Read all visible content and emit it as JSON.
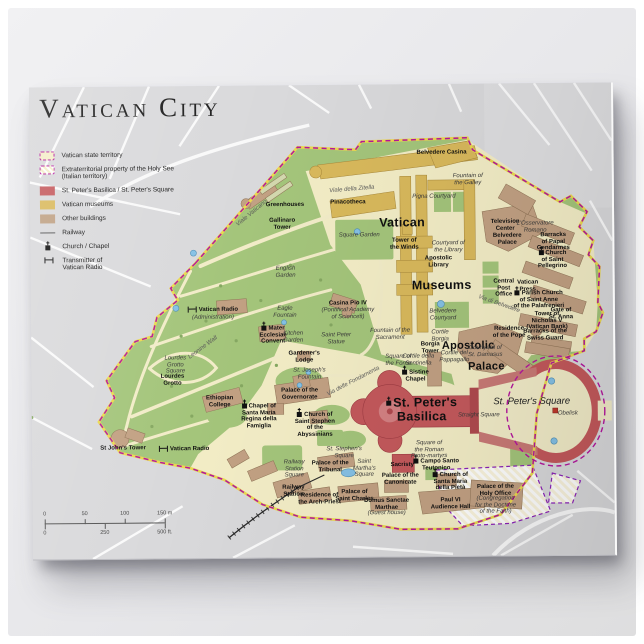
{
  "title": "Vatican City",
  "legend": {
    "items": [
      {
        "type": "territory",
        "label": "Vatican state territory"
      },
      {
        "type": "extraterritorial",
        "label": "Extraterritorial property of the Holy See\n(Italian territory)"
      },
      {
        "type": "basilica",
        "label": "St. Peter's Basilica / St. Peter's Square"
      },
      {
        "type": "museums",
        "label": "Vatican museums"
      },
      {
        "type": "buildings",
        "label": "Other buildings"
      },
      {
        "type": "railway",
        "label": "Railway"
      },
      {
        "type": "church",
        "label": "Church / Chapel"
      },
      {
        "type": "transmitter",
        "label": "Transmitter of\nVatican Radio"
      }
    ]
  },
  "scalebar": {
    "meters": [
      "0",
      "50",
      "100",
      "150 m"
    ],
    "feet": [
      "0",
      "250",
      "500 ft."
    ]
  },
  "colors": {
    "map_background": "#d9d9db",
    "territory_green": "#a4c57b",
    "built_area": "#f3edc6",
    "basilica_red": "#c4595c",
    "museums_yellow": "#d9b95c",
    "buildings_tan": "#c2a183",
    "border_magenta": "#b5179e",
    "extraterritorial_purple": "#8b22b8",
    "water_blue": "#85c1e5"
  },
  "map": {
    "labels": [
      {
        "t": "Vatican",
        "x": 372,
        "y": 139,
        "c": "big"
      },
      {
        "t": "Museums",
        "x": 411,
        "y": 202,
        "c": "big"
      },
      {
        "t": "Apostolic",
        "x": 437,
        "y": 262,
        "c": "big2"
      },
      {
        "t": "Palace",
        "x": 455,
        "y": 283,
        "c": "big2"
      },
      {
        "t": "St. Peter's\nBasilica",
        "x": 390,
        "y": 326,
        "c": "big",
        "icon": "church"
      },
      {
        "t": "St. Peter's Square",
        "x": 500,
        "y": 319,
        "c": "bigit"
      },
      {
        "t": "Belvedere Casina",
        "x": 412,
        "y": 69
      },
      {
        "t": "Fountain of\nthe Galley",
        "x": 438,
        "y": 96,
        "c": "it"
      },
      {
        "t": "Pigna Courtyard",
        "x": 404,
        "y": 113,
        "c": "it"
      },
      {
        "t": "Greenhouses",
        "x": 255,
        "y": 120
      },
      {
        "t": "Gallinaro\nTower",
        "x": 252,
        "y": 139
      },
      {
        "t": "Viale della Zitella",
        "x": 322,
        "y": 105,
        "c": "road",
        "r": -4
      },
      {
        "t": "Pinacotheca",
        "x": 318,
        "y": 118
      },
      {
        "t": "Square Garden",
        "x": 329,
        "y": 151,
        "c": "it"
      },
      {
        "t": "English\nGarden",
        "x": 255,
        "y": 187,
        "c": "it"
      },
      {
        "t": "Viale Vaticano",
        "x": 222,
        "y": 128,
        "c": "road",
        "r": -39
      },
      {
        "t": "Tower of\nthe Winds",
        "x": 374,
        "y": 160
      },
      {
        "t": "Courtyard of\nthe Library",
        "x": 418,
        "y": 163,
        "c": "it"
      },
      {
        "t": "Apostolic\nLibrary",
        "x": 408,
        "y": 178
      },
      {
        "t": "Television\nCenter",
        "x": 475,
        "y": 142
      },
      {
        "t": "L'Osservatore\nRomano",
        "x": 505,
        "y": 144,
        "c": "it"
      },
      {
        "t": "Belvedere\nPalace",
        "x": 477,
        "y": 156
      },
      {
        "t": "Barracks\nof Papal\nGendarmes",
        "x": 523,
        "y": 159
      },
      {
        "t": "Church\nof Saint\nPellegrino",
        "x": 522,
        "y": 177,
        "icon": "church"
      },
      {
        "t": "Central\nPost\nOffice",
        "x": 473,
        "y": 205
      },
      {
        "t": "Vatican\nPress",
        "x": 497,
        "y": 203
      },
      {
        "t": "Parish Church\nof Saint Anne\nof the Palafrenieri",
        "x": 508,
        "y": 217,
        "icon": "church"
      },
      {
        "t": "Gate of\nSt. Anna",
        "x": 530,
        "y": 231
      },
      {
        "t": "Tower of\nNicholas V\n(Vatican Bank)",
        "x": 516,
        "y": 238
      },
      {
        "t": "Barracks of the\nSwiss Guard",
        "x": 514,
        "y": 252
      },
      {
        "t": "Residence\nof the Pope",
        "x": 478,
        "y": 249
      },
      {
        "t": "Via di Belvedere",
        "x": 468,
        "y": 221,
        "c": "road",
        "r": 20
      },
      {
        "t": "Belvedere\nCourtyard",
        "x": 412,
        "y": 231,
        "c": "it"
      },
      {
        "t": "Cortile\nBorgia",
        "x": 409,
        "y": 252,
        "c": "it"
      },
      {
        "t": "Borgia\nTower",
        "x": 399,
        "y": 264
      },
      {
        "t": "Cortile della\nSentinella",
        "x": 387,
        "y": 276,
        "c": "it"
      },
      {
        "t": "Cortile del\nPappagallo",
        "x": 423,
        "y": 273,
        "c": "it"
      },
      {
        "t": "Courtyard of\nSt. Damasus",
        "x": 454,
        "y": 268,
        "c": "it"
      },
      {
        "t": "Sistine\nChapel",
        "x": 384,
        "y": 292,
        "icon": "church"
      },
      {
        "t": "Square of\nthe Forno",
        "x": 367,
        "y": 276,
        "c": "it"
      },
      {
        "t": "Straight Square",
        "x": 447,
        "y": 332,
        "c": "it"
      },
      {
        "t": "Obelisk",
        "x": 536,
        "y": 331,
        "c": "it"
      },
      {
        "t": "Square of\nthe Roman\nProto-martyrs",
        "x": 397,
        "y": 366,
        "c": "it"
      },
      {
        "t": "Sacristy",
        "x": 370,
        "y": 381
      },
      {
        "t": "Campo Santo\nTeutonico",
        "x": 404,
        "y": 381,
        "icon": "church"
      },
      {
        "t": "Church of\nSanta Maria\ndella Pietà",
        "x": 418,
        "y": 398,
        "icon": "church"
      },
      {
        "t": "Paul VI\nAudience Hall",
        "x": 418,
        "y": 420
      },
      {
        "t": "Palace of the\nHoly Office",
        "x": 463,
        "y": 407
      },
      {
        "t": "(Congregation\nfor the Doctrine\nof the Faith)",
        "x": 463,
        "y": 422,
        "c": "it"
      },
      {
        "t": "Palace of the\nCanonicate",
        "x": 368,
        "y": 395
      },
      {
        "t": "Domus Sanctae\nMarthae",
        "x": 354,
        "y": 420
      },
      {
        "t": "(Guest house)",
        "x": 354,
        "y": 429,
        "c": "it"
      },
      {
        "t": "Palace of\nSaint Charles",
        "x": 322,
        "y": 411
      },
      {
        "t": "Residence of\nthe Arch-Priest",
        "x": 287,
        "y": 414
      },
      {
        "t": "Railway\nStation",
        "x": 261,
        "y": 406
      },
      {
        "t": "Railway\nStation\nSquare",
        "x": 262,
        "y": 384,
        "c": "it"
      },
      {
        "t": "Palace of the\nTribunal",
        "x": 298,
        "y": 382
      },
      {
        "t": "Saint\nMartha's\nSquare",
        "x": 332,
        "y": 384,
        "c": "it"
      },
      {
        "t": "St. Stephen's\nSquare",
        "x": 312,
        "y": 368,
        "c": "it"
      },
      {
        "t": "Church of\nSaint Stephen\nof the\nAbyssinians",
        "x": 283,
        "y": 340,
        "icon": "church"
      },
      {
        "t": "Chapel of\nSanta Maria\nRegina della\nFamiglia",
        "x": 227,
        "y": 331,
        "icon": "church"
      },
      {
        "t": "Ethiopian\nCollege",
        "x": 188,
        "y": 316
      },
      {
        "t": "Palace of the\nGovernorate",
        "x": 268,
        "y": 309
      },
      {
        "t": "St. Joseph's\nFountain",
        "x": 278,
        "y": 289,
        "c": "it"
      },
      {
        "t": "Gardener's\nLodge",
        "x": 273,
        "y": 272
      },
      {
        "t": "Saint Peter\nStatue",
        "x": 305,
        "y": 254,
        "c": "it"
      },
      {
        "t": "Fountain of the\nSacrament",
        "x": 359,
        "y": 250,
        "c": "it"
      },
      {
        "t": "Casina Pio IV",
        "x": 317,
        "y": 219
      },
      {
        "t": "(Pontifical Academy\nof Sciences)",
        "x": 317,
        "y": 229,
        "c": "it"
      },
      {
        "t": "Mater\nEcclesiae\nConvent",
        "x": 242,
        "y": 250,
        "icon": "church"
      },
      {
        "t": "Kitchen\nGarden",
        "x": 262,
        "y": 252,
        "c": "it"
      },
      {
        "t": "Eagle\nFountain",
        "x": 254,
        "y": 227,
        "c": "it"
      },
      {
        "t": "Vatican Radio",
        "x": 182,
        "y": 224,
        "icon": "transmitter"
      },
      {
        "t": "(Administration)",
        "x": 182,
        "y": 232,
        "c": "it"
      },
      {
        "t": "Lourdes\nGrotto\nSquare",
        "x": 144,
        "y": 279,
        "c": "it"
      },
      {
        "t": "Lourdes\nGrotto",
        "x": 141,
        "y": 294
      },
      {
        "t": "St John's Tower",
        "x": 91,
        "y": 362
      },
      {
        "t": "Vatican Radio",
        "x": 152,
        "y": 363,
        "icon": "transmitter"
      },
      {
        "t": "Leonine Wall",
        "x": 172,
        "y": 262,
        "c": "road",
        "r": -36
      },
      {
        "t": "Via delle Fondamenta",
        "x": 322,
        "y": 297,
        "c": "road",
        "r": -27
      }
    ]
  }
}
